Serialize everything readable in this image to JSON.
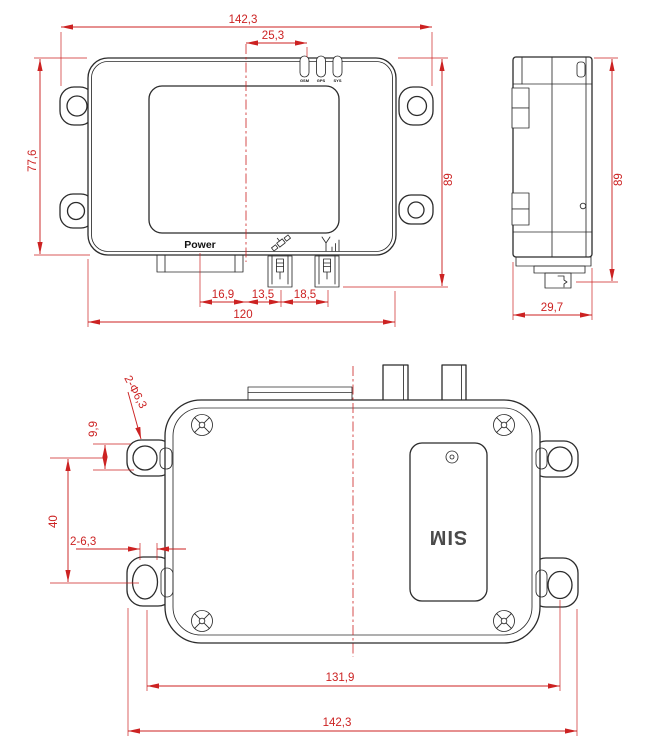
{
  "drawing": {
    "colors": {
      "line": "#2b2b2b",
      "dimension": "#cc2222"
    },
    "front_view": {
      "power_label": "Power",
      "led_labels": [
        "GSM",
        "GPS",
        "SYS"
      ],
      "dims": {
        "overall_width": "142,3",
        "led_offset_from_center": "25,3",
        "body_height": "77,6",
        "overall_height": "89",
        "power_label_offset": "16,9",
        "gps_connector_offset": "13,5",
        "antenna_connector_offset": "18,5",
        "body_width": "120"
      }
    },
    "side_view": {
      "dims": {
        "overall_height": "89",
        "body_depth": "29,7"
      }
    },
    "bottom_view": {
      "sim_label": "SIM",
      "dims": {
        "mounting_hole_callout": "2-Φ6,3",
        "hole_edge_offset": "9,9",
        "hole_vertical_spacing": "40",
        "slot_callout": "2-6,3",
        "hole_horizontal_spacing": "131,9",
        "overall_width": "142,3"
      }
    }
  }
}
